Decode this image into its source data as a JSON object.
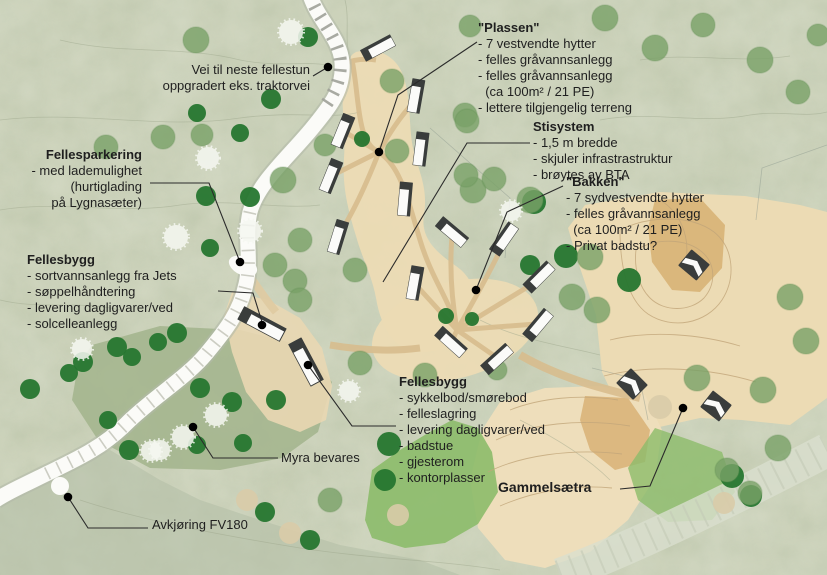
{
  "plan": {
    "type": "site-plan",
    "language": "Norwegian"
  },
  "colors": {
    "text": "#1f1f1f",
    "terrain_base": "#c9cfb6",
    "myra": "#a2b48c",
    "meadow": "#8cbb6a",
    "tan_light": "#ecdbb4",
    "tan_dark": "#d8b276",
    "road_white": "#fbfbf8",
    "tree_dark": "#26762f",
    "tree_mid": "#7aa268",
    "tree_white": "#f6f8f2",
    "tree_pale": "#d9cba8",
    "cabin_dark": "#3a3d3c",
    "cabin_white": "#fbfbf9",
    "leader": "#2b2b2b"
  },
  "annotations": [
    {
      "id": "vei-note",
      "x": 310,
      "y": 62,
      "align": "right",
      "lines": [
        "Vei til neste fellestun",
        "oppgradert eks. traktorvei"
      ]
    },
    {
      "id": "fellesparkering",
      "x": 142,
      "y": 147,
      "align": "right",
      "title": "Fellesparkering",
      "lines": [
        "- med lademulighet",
        "(hurtiglading",
        "på Lygnasæter)"
      ]
    },
    {
      "id": "fellesbygg-vest",
      "x": 27,
      "y": 252,
      "align": "left",
      "title": "Fellesbygg",
      "lines": [
        "- sortvannsanlegg fra Jets",
        "- søppelhåndtering",
        "- levering dagligvarer/ved",
        "- solcelleanlegg"
      ]
    },
    {
      "id": "plassen",
      "x": 478,
      "y": 20,
      "align": "left",
      "title": "\"Plassen\"",
      "lines": [
        "- 7 vestvendte hytter",
        "- felles gråvannsanlegg",
        "- felles gråvannsanlegg",
        "  (ca 100m² / 21 PE)",
        "- lettere tilgjengelig terreng"
      ]
    },
    {
      "id": "stisystem",
      "x": 533,
      "y": 119,
      "align": "left",
      "title": "Stisystem",
      "lines": [
        "- 1,5 m bredde",
        "- skjuler infrastrastruktur",
        "- brøytes av BTA"
      ]
    },
    {
      "id": "bakken",
      "x": 566,
      "y": 174,
      "align": "left",
      "title": "\"Bakken\"",
      "lines": [
        "- 7 sydvestvendte hytter",
        "- felles gråvannsanlegg",
        "  (ca 100m² / 21 PE)",
        "- Privat badstu?"
      ]
    },
    {
      "id": "fellesbygg-sor",
      "x": 399,
      "y": 374,
      "align": "left",
      "title": "Fellesbygg",
      "lines": [
        "- sykkelbod/smørebod",
        "- felleslagring",
        "- levering dagligvarer/ved",
        "- badstue",
        "- gjesterom",
        "- kontorplasser"
      ]
    },
    {
      "id": "myra",
      "x": 281,
      "y": 450,
      "align": "left",
      "lines": [
        "Myra bevares"
      ]
    },
    {
      "id": "gammelsaetra",
      "x": 498,
      "y": 479,
      "align": "left",
      "size": 14,
      "title": "Gammelsætra",
      "lines": []
    },
    {
      "id": "avkjoring",
      "x": 152,
      "y": 517,
      "align": "left",
      "lines": [
        "Avkjøring FV180"
      ]
    }
  ],
  "map": {
    "dots": [
      [
        328,
        67
      ],
      [
        240,
        262
      ],
      [
        262,
        325
      ],
      [
        308,
        365
      ],
      [
        379,
        152
      ],
      [
        476,
        290
      ],
      [
        193,
        427
      ],
      [
        68,
        497
      ],
      [
        683,
        408
      ]
    ],
    "leaders": [
      {
        "to": "road-north",
        "pts": [
          [
            313,
            76
          ],
          [
            328,
            67
          ]
        ]
      },
      {
        "to": "parking",
        "pts": [
          [
            150,
            183
          ],
          [
            209,
            183
          ],
          [
            240,
            262
          ]
        ]
      },
      {
        "to": "fellesbygg-vest",
        "pts": [
          [
            218,
            291
          ],
          [
            253,
            293
          ],
          [
            262,
            322
          ]
        ]
      },
      {
        "to": "plassen-tun",
        "pts": [
          [
            477,
            42
          ],
          [
            398,
            95
          ],
          [
            379,
            152
          ]
        ]
      },
      {
        "to": "stisystem",
        "pts": [
          [
            530,
            143
          ],
          [
            467,
            143
          ],
          [
            383,
            282
          ]
        ]
      },
      {
        "to": "bakken-tun",
        "pts": [
          [
            563,
            186
          ],
          [
            507,
            212
          ],
          [
            476,
            290
          ]
        ]
      },
      {
        "to": "fellesbygg-sor",
        "pts": [
          [
            396,
            426
          ],
          [
            352,
            426
          ],
          [
            308,
            365
          ]
        ]
      },
      {
        "to": "myra",
        "pts": [
          [
            278,
            458
          ],
          [
            213,
            458
          ],
          [
            193,
            427
          ]
        ]
      },
      {
        "to": "gammelsaetra",
        "pts": [
          [
            620,
            489
          ],
          [
            650,
            486
          ],
          [
            683,
            408
          ]
        ]
      },
      {
        "to": "avkjoring-fv180",
        "pts": [
          [
            148,
            528
          ],
          [
            88,
            528
          ],
          [
            68,
            497
          ]
        ]
      }
    ],
    "cabins": [
      {
        "x": 378,
        "y": 48,
        "rot": -28,
        "type": "long"
      },
      {
        "x": 416,
        "y": 96,
        "rot": 100,
        "type": "long"
      },
      {
        "x": 343,
        "y": 131,
        "rot": 112,
        "type": "long"
      },
      {
        "x": 421,
        "y": 149,
        "rot": 97,
        "type": "long"
      },
      {
        "x": 331,
        "y": 176,
        "rot": 112,
        "type": "long"
      },
      {
        "x": 405,
        "y": 199,
        "rot": 95,
        "type": "long"
      },
      {
        "x": 338,
        "y": 237,
        "rot": 107,
        "type": "long"
      },
      {
        "x": 452,
        "y": 232,
        "rot": 40,
        "type": "long"
      },
      {
        "x": 504,
        "y": 239,
        "rot": -55,
        "type": "long"
      },
      {
        "x": 539,
        "y": 277,
        "rot": -45,
        "type": "long"
      },
      {
        "x": 538,
        "y": 325,
        "rot": -50,
        "type": "long"
      },
      {
        "x": 497,
        "y": 359,
        "rot": -42,
        "type": "long"
      },
      {
        "x": 451,
        "y": 342,
        "rot": 42,
        "type": "long"
      },
      {
        "x": 415,
        "y": 283,
        "rot": 100,
        "type": "long"
      },
      {
        "x": 262,
        "y": 324,
        "rot": 28,
        "type": "big"
      },
      {
        "x": 306,
        "y": 362,
        "rot": 62,
        "type": "big"
      },
      {
        "x": 694,
        "y": 265,
        "rot": 40,
        "type": "hut"
      },
      {
        "x": 632,
        "y": 384,
        "rot": 45,
        "type": "hut"
      },
      {
        "x": 716,
        "y": 406,
        "rot": 38,
        "type": "hut"
      }
    ],
    "trees": [
      {
        "x": 271,
        "y": 99,
        "r": 10,
        "t": "d"
      },
      {
        "x": 240,
        "y": 133,
        "r": 9,
        "t": "d"
      },
      {
        "x": 197,
        "y": 113,
        "r": 9,
        "t": "d"
      },
      {
        "x": 362,
        "y": 139,
        "r": 8,
        "t": "d"
      },
      {
        "x": 308,
        "y": 37,
        "r": 10,
        "t": "d"
      },
      {
        "x": 206,
        "y": 196,
        "r": 10,
        "t": "d"
      },
      {
        "x": 250,
        "y": 197,
        "r": 10,
        "t": "d"
      },
      {
        "x": 210,
        "y": 248,
        "r": 9,
        "t": "d"
      },
      {
        "x": 83,
        "y": 362,
        "r": 10,
        "t": "d"
      },
      {
        "x": 69,
        "y": 373,
        "r": 9,
        "t": "d"
      },
      {
        "x": 117,
        "y": 347,
        "r": 10,
        "t": "d"
      },
      {
        "x": 132,
        "y": 357,
        "r": 9,
        "t": "d"
      },
      {
        "x": 177,
        "y": 333,
        "r": 10,
        "t": "d"
      },
      {
        "x": 158,
        "y": 342,
        "r": 9,
        "t": "d"
      },
      {
        "x": 30,
        "y": 389,
        "r": 10,
        "t": "d"
      },
      {
        "x": 108,
        "y": 420,
        "r": 9,
        "t": "d"
      },
      {
        "x": 200,
        "y": 388,
        "r": 10,
        "t": "d"
      },
      {
        "x": 232,
        "y": 402,
        "r": 10,
        "t": "d"
      },
      {
        "x": 276,
        "y": 400,
        "r": 10,
        "t": "d"
      },
      {
        "x": 129,
        "y": 450,
        "r": 10,
        "t": "d"
      },
      {
        "x": 197,
        "y": 445,
        "r": 9,
        "t": "d"
      },
      {
        "x": 243,
        "y": 443,
        "r": 9,
        "t": "d"
      },
      {
        "x": 446,
        "y": 316,
        "r": 8,
        "t": "d"
      },
      {
        "x": 472,
        "y": 319,
        "r": 7,
        "t": "d"
      },
      {
        "x": 534,
        "y": 202,
        "r": 12,
        "t": "d"
      },
      {
        "x": 566,
        "y": 256,
        "r": 12,
        "t": "d"
      },
      {
        "x": 629,
        "y": 280,
        "r": 12,
        "t": "d"
      },
      {
        "x": 732,
        "y": 476,
        "r": 12,
        "t": "d"
      },
      {
        "x": 751,
        "y": 496,
        "r": 11,
        "t": "d"
      },
      {
        "x": 389,
        "y": 444,
        "r": 12,
        "t": "d"
      },
      {
        "x": 385,
        "y": 480,
        "r": 11,
        "t": "d"
      },
      {
        "x": 265,
        "y": 512,
        "r": 10,
        "t": "d"
      },
      {
        "x": 310,
        "y": 540,
        "r": 10,
        "t": "d"
      },
      {
        "x": 530,
        "y": 265,
        "r": 10,
        "t": "d"
      },
      {
        "x": 196,
        "y": 40,
        "r": 13,
        "t": "m"
      },
      {
        "x": 106,
        "y": 147,
        "r": 12,
        "t": "m"
      },
      {
        "x": 163,
        "y": 137,
        "r": 12,
        "t": "m"
      },
      {
        "x": 202,
        "y": 135,
        "r": 11,
        "t": "m"
      },
      {
        "x": 283,
        "y": 180,
        "r": 13,
        "t": "m"
      },
      {
        "x": 275,
        "y": 265,
        "r": 12,
        "t": "m"
      },
      {
        "x": 295,
        "y": 281,
        "r": 12,
        "t": "m"
      },
      {
        "x": 355,
        "y": 270,
        "r": 12,
        "t": "m"
      },
      {
        "x": 360,
        "y": 363,
        "r": 12,
        "t": "m"
      },
      {
        "x": 325,
        "y": 145,
        "r": 11,
        "t": "m"
      },
      {
        "x": 392,
        "y": 81,
        "r": 12,
        "t": "m"
      },
      {
        "x": 465,
        "y": 115,
        "r": 12,
        "t": "m"
      },
      {
        "x": 470,
        "y": 26,
        "r": 11,
        "t": "m"
      },
      {
        "x": 397,
        "y": 151,
        "r": 12,
        "t": "m"
      },
      {
        "x": 473,
        "y": 190,
        "r": 13,
        "t": "m"
      },
      {
        "x": 530,
        "y": 200,
        "r": 13,
        "t": "m"
      },
      {
        "x": 590,
        "y": 257,
        "r": 13,
        "t": "m"
      },
      {
        "x": 572,
        "y": 297,
        "r": 13,
        "t": "m"
      },
      {
        "x": 597,
        "y": 310,
        "r": 13,
        "t": "m"
      },
      {
        "x": 466,
        "y": 175,
        "r": 12,
        "t": "m"
      },
      {
        "x": 494,
        "y": 179,
        "r": 12,
        "t": "m"
      },
      {
        "x": 467,
        "y": 121,
        "r": 12,
        "t": "m"
      },
      {
        "x": 605,
        "y": 18,
        "r": 13,
        "t": "m"
      },
      {
        "x": 655,
        "y": 48,
        "r": 13,
        "t": "m"
      },
      {
        "x": 703,
        "y": 25,
        "r": 12,
        "t": "m"
      },
      {
        "x": 760,
        "y": 60,
        "r": 13,
        "t": "m"
      },
      {
        "x": 798,
        "y": 92,
        "r": 12,
        "t": "m"
      },
      {
        "x": 818,
        "y": 35,
        "r": 11,
        "t": "m"
      },
      {
        "x": 790,
        "y": 297,
        "r": 13,
        "t": "m"
      },
      {
        "x": 806,
        "y": 341,
        "r": 13,
        "t": "m"
      },
      {
        "x": 697,
        "y": 378,
        "r": 13,
        "t": "m"
      },
      {
        "x": 763,
        "y": 390,
        "r": 13,
        "t": "m"
      },
      {
        "x": 778,
        "y": 448,
        "r": 13,
        "t": "m"
      },
      {
        "x": 727,
        "y": 470,
        "r": 12,
        "t": "m"
      },
      {
        "x": 750,
        "y": 493,
        "r": 12,
        "t": "m"
      },
      {
        "x": 425,
        "y": 375,
        "r": 12,
        "t": "m"
      },
      {
        "x": 497,
        "y": 370,
        "r": 10,
        "t": "m"
      },
      {
        "x": 330,
        "y": 500,
        "r": 12,
        "t": "m"
      },
      {
        "x": 300,
        "y": 240,
        "r": 12,
        "t": "m"
      },
      {
        "x": 300,
        "y": 300,
        "r": 12,
        "t": "m"
      },
      {
        "x": 208,
        "y": 158,
        "r": 11,
        "t": "w"
      },
      {
        "x": 291,
        "y": 32,
        "r": 12,
        "t": "w"
      },
      {
        "x": 176,
        "y": 237,
        "r": 12,
        "t": "w"
      },
      {
        "x": 250,
        "y": 231,
        "r": 11,
        "t": "w"
      },
      {
        "x": 82,
        "y": 349,
        "r": 10,
        "t": "w"
      },
      {
        "x": 183,
        "y": 437,
        "r": 11,
        "t": "w"
      },
      {
        "x": 160,
        "y": 450,
        "r": 10,
        "t": "w"
      },
      {
        "x": 216,
        "y": 415,
        "r": 11,
        "t": "w"
      },
      {
        "x": 151,
        "y": 451,
        "r": 10,
        "t": "w"
      },
      {
        "x": 511,
        "y": 211,
        "r": 10,
        "t": "w"
      },
      {
        "x": 349,
        "y": 391,
        "r": 10,
        "t": "w"
      },
      {
        "x": 247,
        "y": 500,
        "r": 11,
        "t": "p"
      },
      {
        "x": 290,
        "y": 533,
        "r": 11,
        "t": "p"
      },
      {
        "x": 660,
        "y": 407,
        "r": 12,
        "t": "p"
      },
      {
        "x": 398,
        "y": 515,
        "r": 11,
        "t": "p"
      },
      {
        "x": 724,
        "y": 503,
        "r": 11,
        "t": "p"
      }
    ]
  }
}
